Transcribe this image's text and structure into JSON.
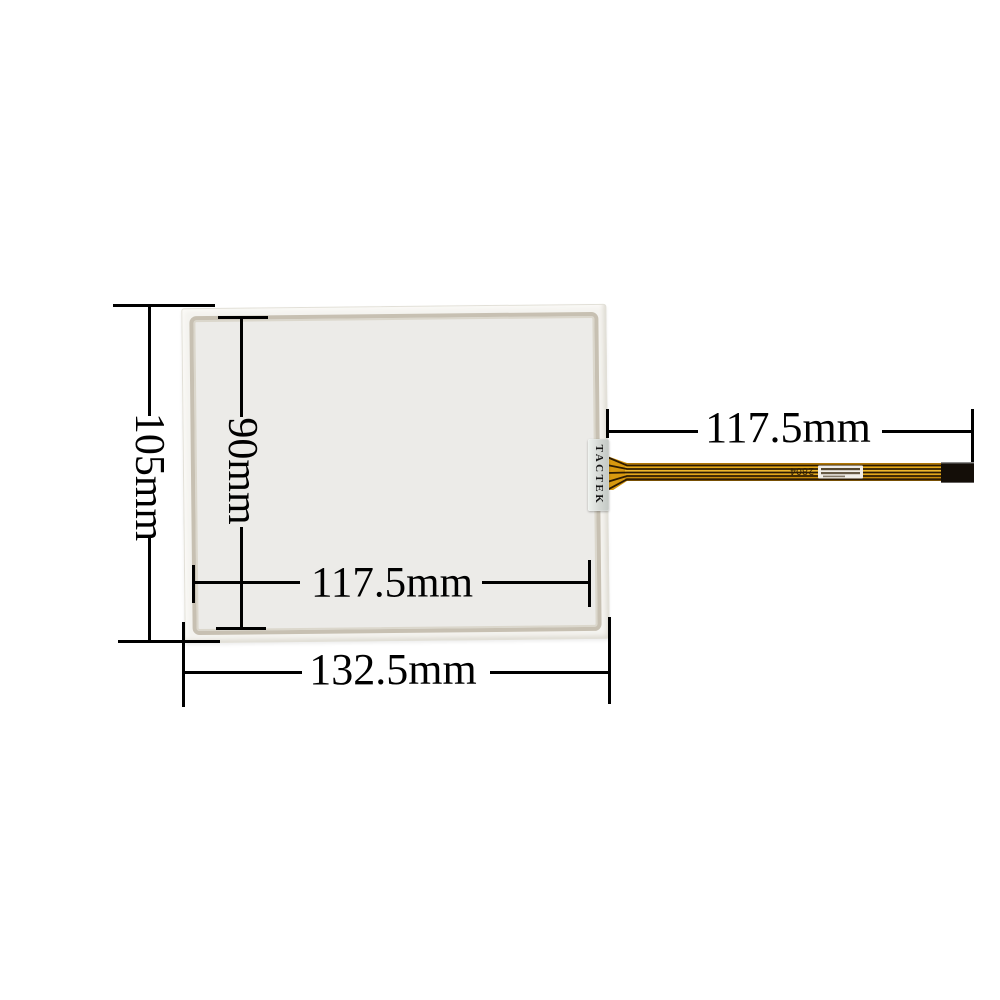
{
  "product": {
    "brand_label": "TACTEK",
    "cable_marking": "2804",
    "description": "4-wire resistive touch screen glass panel with flex ribbon cable"
  },
  "dimensions": {
    "panel_height": "105mm",
    "active_area_height": "90mm",
    "active_area_width": "117.5mm",
    "panel_width": "132.5mm",
    "cable_length": "117.5mm"
  },
  "colors": {
    "background": "#ffffff",
    "dimension_line": "#000000",
    "panel_frame": "#f4f3ef",
    "panel_inner_border": "#c7c0b2",
    "panel_surface": "#ecebe8",
    "label_background": "#d9dcd9",
    "cable_gold": "#d8990f",
    "cable_trace_dark": "#2d1b02",
    "connector_black": "#140e08"
  }
}
